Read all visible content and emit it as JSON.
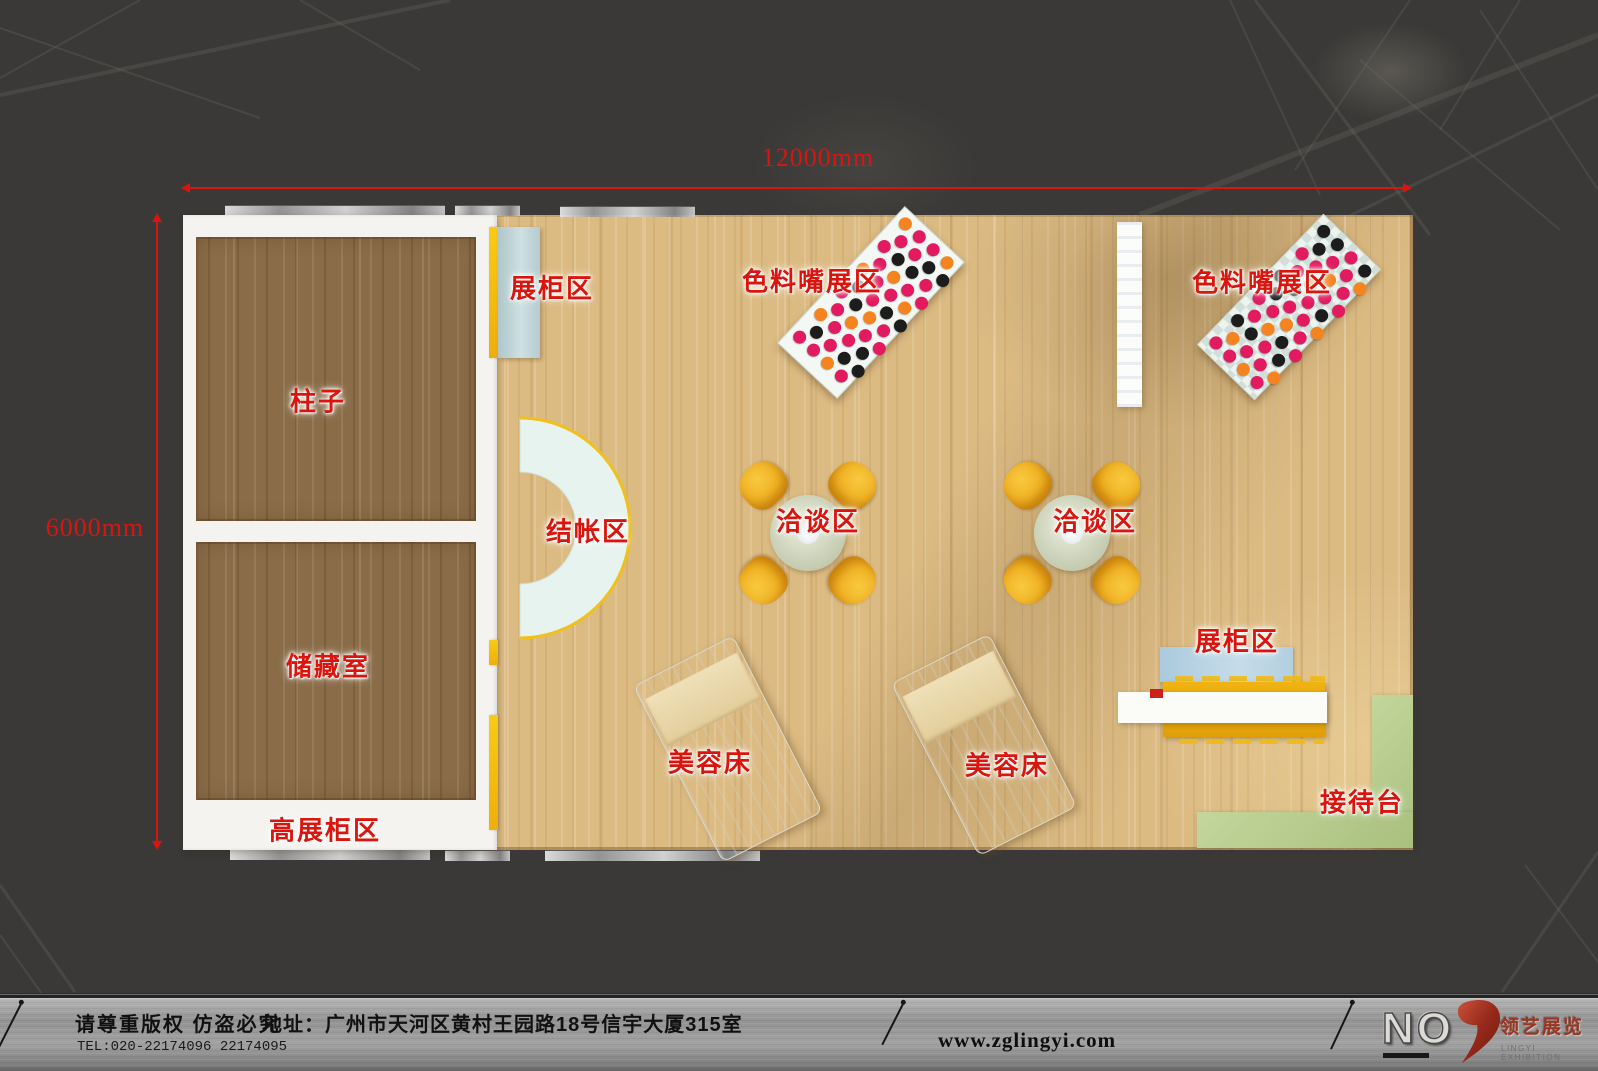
{
  "dimensions": {
    "width": "12000mm",
    "height": "6000mm"
  },
  "areas": {
    "pillar": "柱子",
    "storage_room": "储藏室",
    "tall_showcase": "高展柜区",
    "showcase_left": "展柜区",
    "showcase_right": "展柜区",
    "checkout": "结帐区",
    "nozzle_display_left": "色料嘴展区",
    "nozzle_display_right": "色料嘴展区",
    "negotiation_left": "洽谈区",
    "negotiation_right": "洽谈区",
    "beauty_bed_left": "美容床",
    "beauty_bed_right": "美容床",
    "reception": "接待台"
  },
  "nozzle_table": {
    "rows": 11,
    "cols": 4,
    "dot_colors": [
      "#f5831f",
      "#1c1c1c",
      "#e21a60"
    ]
  },
  "footer": {
    "copyright": "请尊重版权 仿盗必究",
    "tel": "TEL:020-22174096 22174095",
    "address": "地址：广州市天河区黄村王园路18号信宇大厦315室",
    "website": "www.zglingyi.com",
    "logo_no": "NO",
    "logo_brand_cn": "领艺展览",
    "logo_brand_en": "LINGYI EXHIBITION"
  },
  "colors": {
    "annotation_red": "#d9150f",
    "floor_wood": "#dcbb83",
    "room_wood": "#8a6c48",
    "wall_white": "#f4f3f0",
    "accent_yellow": "#f2b713",
    "cabinet_blue": "#b9cfd4",
    "counter_mint": "#e7f3ee",
    "chair_yellow": "#f2b32d",
    "reception_green": "#b7cc8f",
    "background": "#3a3937",
    "footer_metal": "#9a9a9a"
  }
}
